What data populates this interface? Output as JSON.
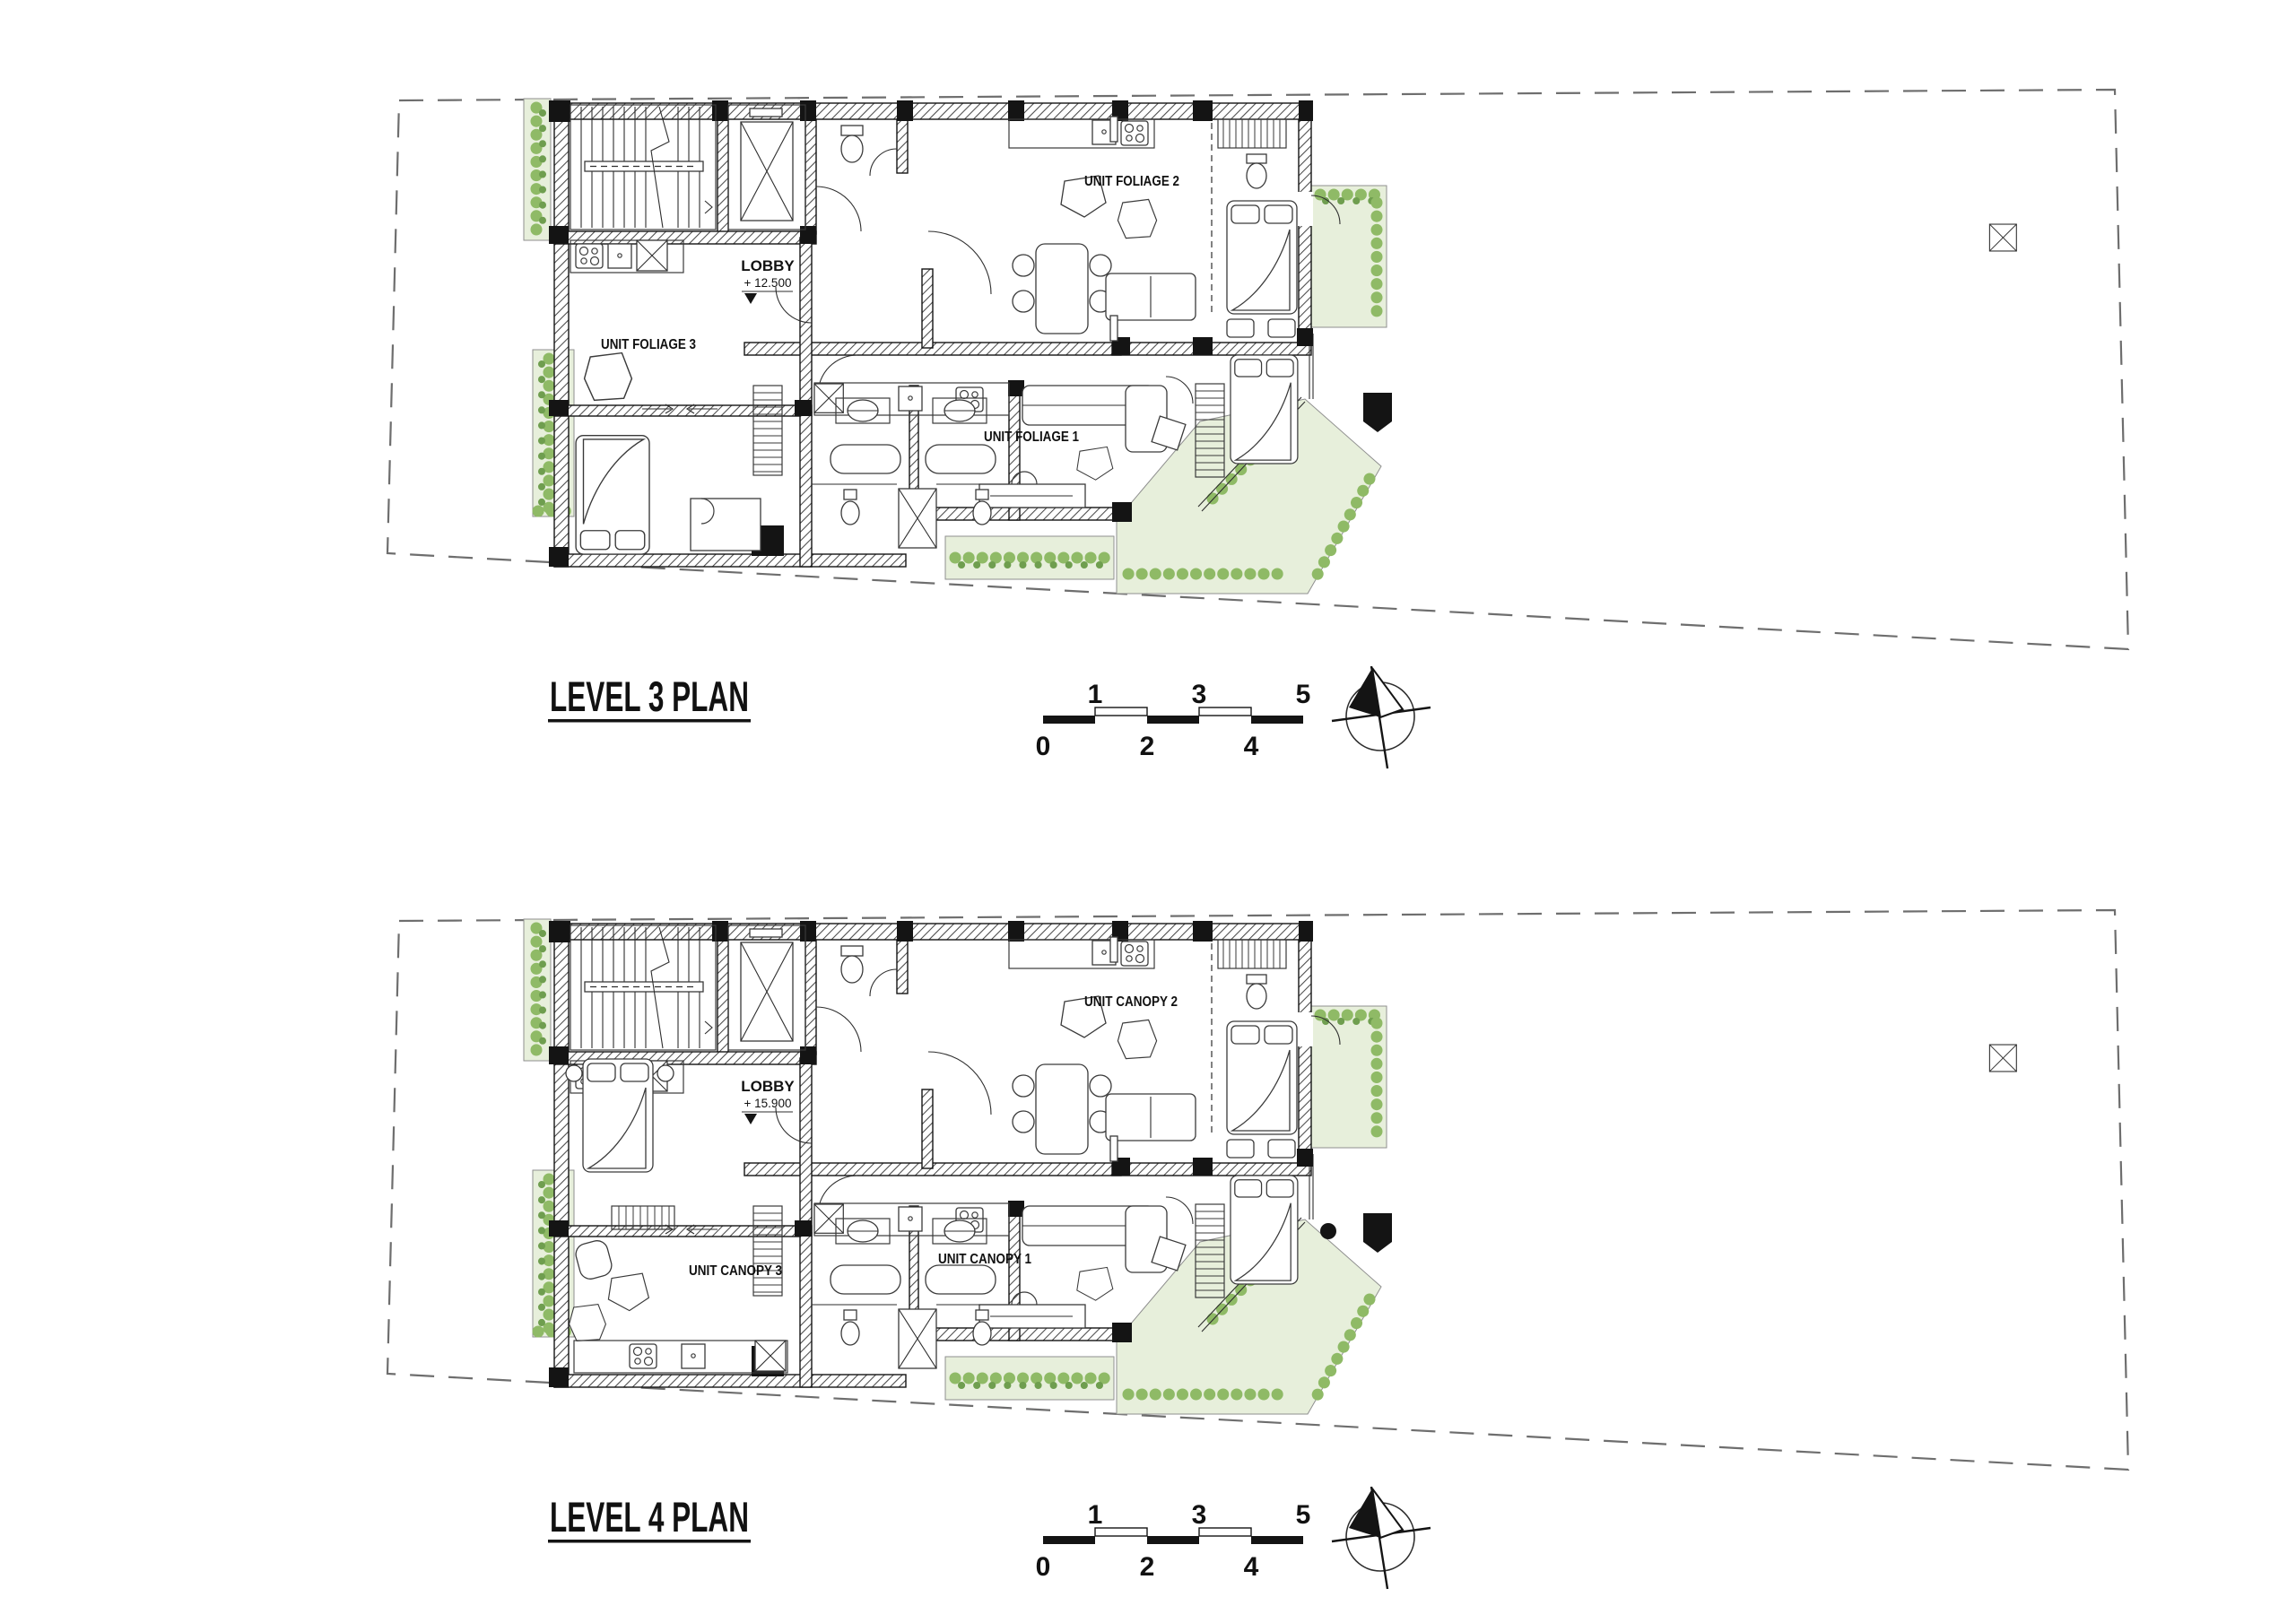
{
  "document": {
    "type": "architectural-floor-plan-sheet",
    "background": "#ffffff"
  },
  "plans": [
    {
      "title": "LEVEL 3 PLAN",
      "lobby_label": "LOBBY",
      "lobby_elevation": "+ 12.500",
      "unit_top_right": "UNIT FOLIAGE 2",
      "unit_left": "UNIT FOLIAGE 3",
      "unit_bottom": "UNIT FOLIAGE 1"
    },
    {
      "title": "LEVEL 4 PLAN",
      "lobby_label": "LOBBY",
      "lobby_elevation": "+ 15.900",
      "unit_top_right": "UNIT CANOPY 2",
      "unit_left": "UNIT CANOPY 3",
      "unit_bottom": "UNIT CANOPY 1"
    }
  ],
  "scale_bar": {
    "top_labels": [
      "1",
      "3",
      "5"
    ],
    "bottom_labels": [
      "0",
      "2",
      "4"
    ]
  },
  "icons": {
    "compass": "north-arrow-icon",
    "stairs": "stair-flight-icon",
    "elevator": "elevator-shaft-icon"
  },
  "colors": {
    "wall": "#141414",
    "line": "#2e2e2e",
    "boundary": "#6e6e6e",
    "green_mid": "#8fba66",
    "green_dark": "#6f9e4f",
    "green_wash": "#e7efdb",
    "paper": "#ffffff"
  }
}
